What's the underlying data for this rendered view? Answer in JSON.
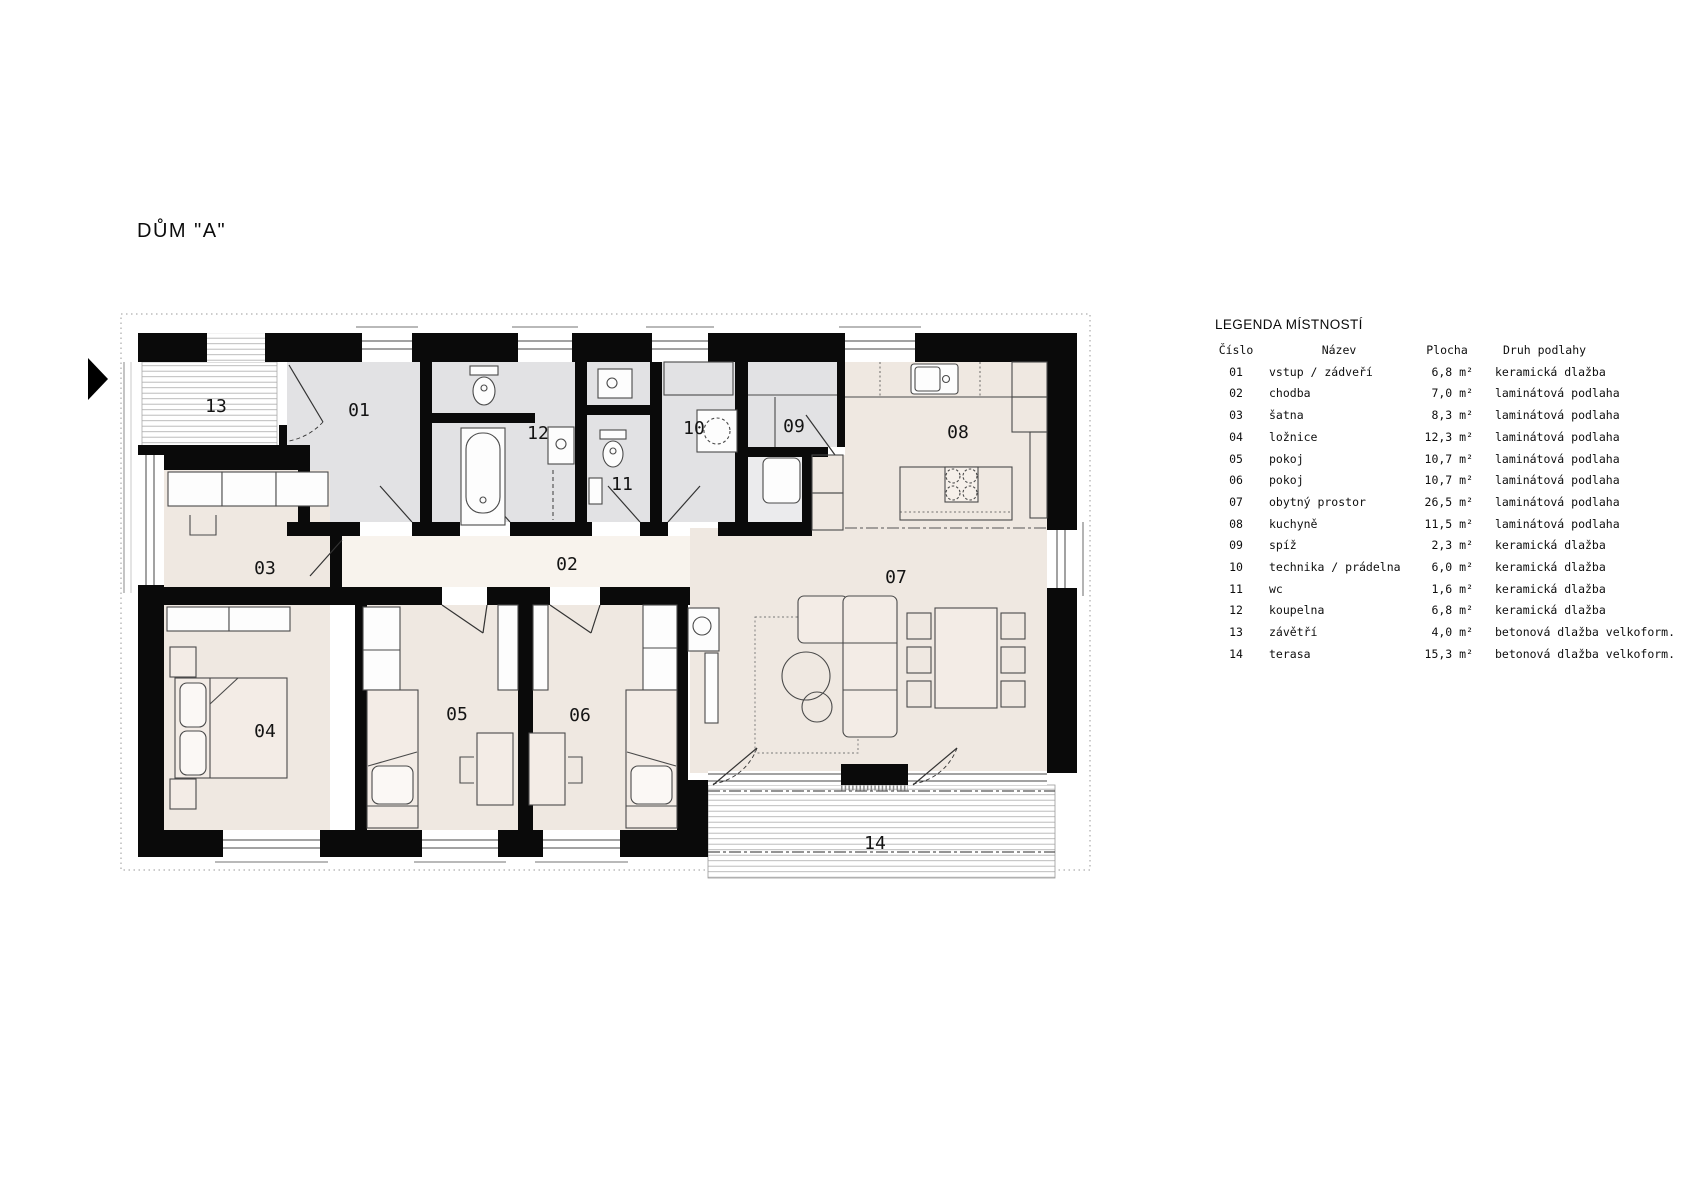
{
  "title": "DŮM \"A\"",
  "legend": {
    "heading": "LEGENDA MÍSTNOSTÍ",
    "columns": {
      "number": "Číslo",
      "name": "Název",
      "area": "Plocha",
      "floor": "Druh podlahy"
    },
    "rows": [
      {
        "number": "01",
        "name": "vstup / zádveří",
        "area": "6,8 m²",
        "floor": "keramická dlažba"
      },
      {
        "number": "02",
        "name": "chodba",
        "area": "7,0 m²",
        "floor": "laminátová podlaha"
      },
      {
        "number": "03",
        "name": "šatna",
        "area": "8,3 m²",
        "floor": "laminátová podlaha"
      },
      {
        "number": "04",
        "name": "ložnice",
        "area": "12,3 m²",
        "floor": "laminátová podlaha"
      },
      {
        "number": "05",
        "name": "pokoj",
        "area": "10,7 m²",
        "floor": "laminátová podlaha"
      },
      {
        "number": "06",
        "name": "pokoj",
        "area": "10,7 m²",
        "floor": "laminátová podlaha"
      },
      {
        "number": "07",
        "name": "obytný prostor",
        "area": "26,5 m²",
        "floor": "laminátová podlaha"
      },
      {
        "number": "08",
        "name": "kuchyně",
        "area": "11,5 m²",
        "floor": "laminátová podlaha"
      },
      {
        "number": "09",
        "name": "spíž",
        "area": "2,3 m²",
        "floor": "keramická dlažba"
      },
      {
        "number": "10",
        "name": "technika / prádelna",
        "area": "6,0 m²",
        "floor": "keramická dlažba"
      },
      {
        "number": "11",
        "name": "wc",
        "area": "1,6 m²",
        "floor": "keramická dlažba"
      },
      {
        "number": "12",
        "name": "koupelna",
        "area": "6,8 m²",
        "floor": "keramická dlažba"
      },
      {
        "number": "13",
        "name": "závětří",
        "area": "4,0 m²",
        "floor": "betonová dlažba velkoform."
      },
      {
        "number": "14",
        "name": "terasa",
        "area": "15,3 m²",
        "floor": "betonová dlažba velkoform."
      }
    ]
  },
  "plan": {
    "room_labels": [
      "01",
      "02",
      "03",
      "04",
      "05",
      "06",
      "07",
      "08",
      "09",
      "10",
      "11",
      "12",
      "13",
      "14"
    ]
  },
  "colors": {
    "wall": "#0a0a0a",
    "service_room": "#e2e2e4",
    "living_room": "#efe8e1",
    "corridor": "#f8f3ed",
    "hatch": "#b5b5b5",
    "text": "#141414"
  }
}
